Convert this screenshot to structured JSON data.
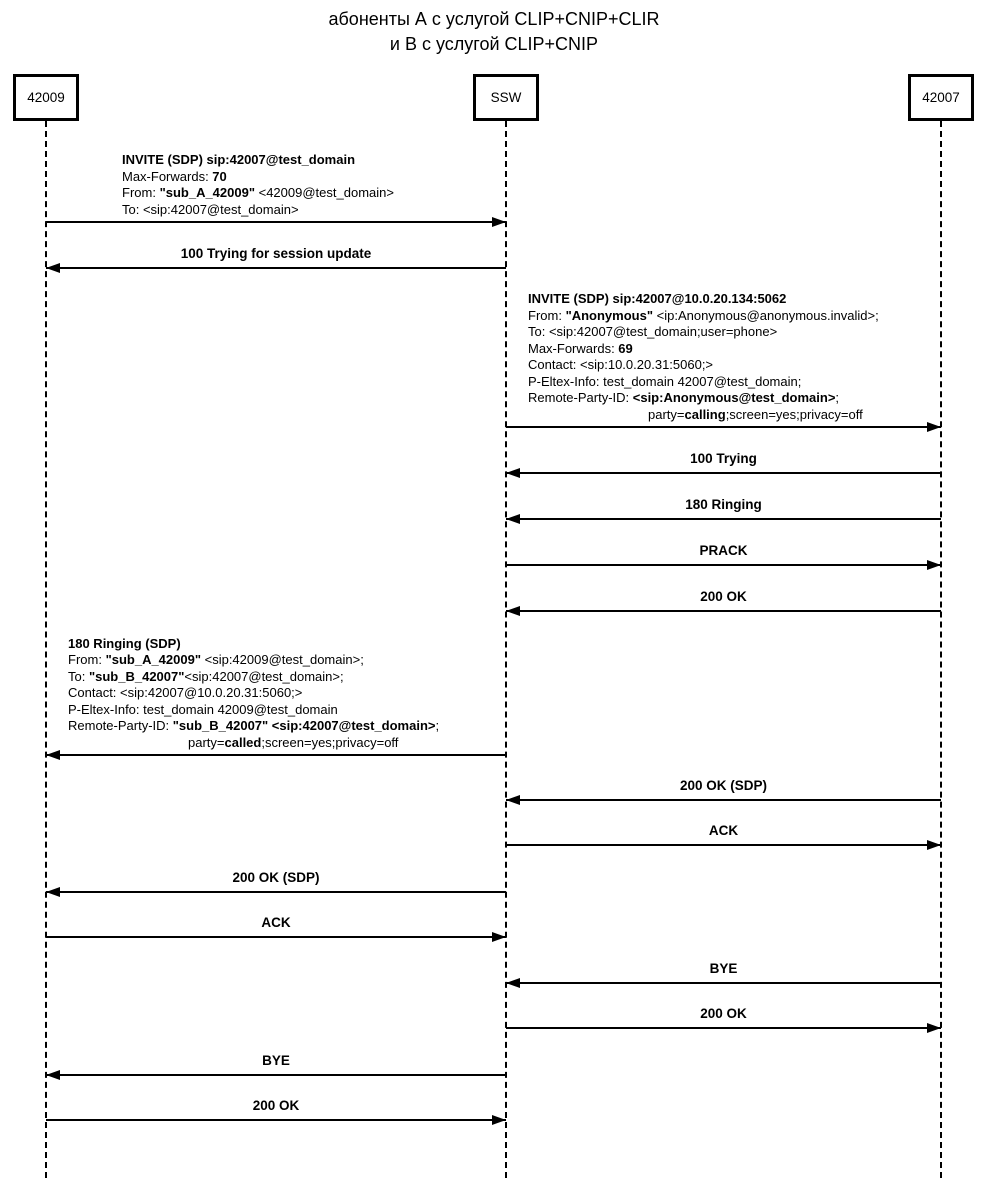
{
  "title": {
    "line1": "абоненты А с услугой CLIP+CNIP+CLIR",
    "line2": "и В с услугой CLIP+CNIP"
  },
  "accent_color": "#000000",
  "actors": [
    {
      "label": "42009",
      "x": 46
    },
    {
      "label": "SSW",
      "x": 506
    },
    {
      "label": "42007",
      "x": 941
    }
  ],
  "messages": [
    {
      "y": 222,
      "from": 46,
      "to": 506,
      "label_style": "block",
      "block_x": 122,
      "lines": [
        {
          "segs": [
            {
              "t": "INVITE (SDP) sip:42007@test_domain",
              "b": true
            }
          ]
        },
        {
          "segs": [
            {
              "t": "Max-Forwards: "
            },
            {
              "t": "70",
              "b": true
            }
          ]
        },
        {
          "segs": [
            {
              "t": "From: "
            },
            {
              "t": "\"sub_A_42009\"",
              "b": true
            },
            {
              "t": " <42009@test_domain>"
            }
          ]
        },
        {
          "segs": [
            {
              "t": "To: <sip:42007@test_domain>"
            }
          ]
        }
      ]
    },
    {
      "y": 268,
      "from": 506,
      "to": 46,
      "label_style": "center",
      "label": "100 Trying for session update"
    },
    {
      "y": 427,
      "from": 506,
      "to": 941,
      "label_style": "block",
      "block_x": 528,
      "lines": [
        {
          "segs": [
            {
              "t": "INVITE (SDP) sip:42007@10.0.20.134:5062",
              "b": true
            }
          ]
        },
        {
          "segs": [
            {
              "t": "From: "
            },
            {
              "t": "\"Anonymous\"",
              "b": true
            },
            {
              "t": " <ip:Anonymous@anonymous.invalid>;"
            }
          ]
        },
        {
          "segs": [
            {
              "t": "To: <sip:42007@test_domain;user=phone>"
            }
          ]
        },
        {
          "segs": [
            {
              "t": "Max-Forwards: "
            },
            {
              "t": "69",
              "b": true
            }
          ]
        },
        {
          "segs": [
            {
              "t": "Contact: <sip:10.0.20.31:5060;>"
            }
          ]
        },
        {
          "segs": [
            {
              "t": "P-Eltex-Info: test_domain 42007@test_domain;"
            }
          ]
        },
        {
          "segs": [
            {
              "t": "Remote-Party-ID: "
            },
            {
              "t": "<sip:Anonymous@test_domain>",
              "b": true
            },
            {
              "t": ";"
            }
          ]
        },
        {
          "indent": 120,
          "segs": [
            {
              "t": "party="
            },
            {
              "t": "calling",
              "b": true
            },
            {
              "t": ";screen=yes;privacy=off"
            }
          ]
        }
      ]
    },
    {
      "y": 473,
      "from": 941,
      "to": 506,
      "label_style": "center",
      "label": "100 Trying"
    },
    {
      "y": 519,
      "from": 941,
      "to": 506,
      "label_style": "center",
      "label": "180 Ringing"
    },
    {
      "y": 565,
      "from": 506,
      "to": 941,
      "label_style": "center",
      "label": "PRACK"
    },
    {
      "y": 611,
      "from": 941,
      "to": 506,
      "label_style": "center",
      "label": "200 OK"
    },
    {
      "y": 755,
      "from": 506,
      "to": 46,
      "label_style": "block",
      "block_x": 68,
      "lines": [
        {
          "segs": [
            {
              "t": "180 Ringing (SDP)",
              "b": true
            }
          ]
        },
        {
          "segs": [
            {
              "t": "From: "
            },
            {
              "t": "\"sub_A_42009\"",
              "b": true
            },
            {
              "t": " <sip:42009@test_domain>;"
            }
          ]
        },
        {
          "segs": [
            {
              "t": "To: "
            },
            {
              "t": "\"sub_B_42007\"",
              "b": true
            },
            {
              "t": "<sip:42007@test_domain>;"
            }
          ]
        },
        {
          "segs": [
            {
              "t": "Contact: <sip:42007@10.0.20.31:5060;>"
            }
          ]
        },
        {
          "segs": [
            {
              "t": "P-Eltex-Info: test_domain 42009@test_domain"
            }
          ]
        },
        {
          "segs": [
            {
              "t": "Remote-Party-ID: "
            },
            {
              "t": "\"sub_B_42007\" <sip:42007@test_domain>",
              "b": true
            },
            {
              "t": ";"
            }
          ]
        },
        {
          "indent": 120,
          "segs": [
            {
              "t": "party="
            },
            {
              "t": "called",
              "b": true
            },
            {
              "t": ";screen=yes;privacy=off"
            }
          ]
        }
      ]
    },
    {
      "y": 800,
      "from": 941,
      "to": 506,
      "label_style": "center",
      "label": "200 OK (SDP)"
    },
    {
      "y": 845,
      "from": 506,
      "to": 941,
      "label_style": "center",
      "label": "ACK"
    },
    {
      "y": 892,
      "from": 506,
      "to": 46,
      "label_style": "center",
      "label": "200 OK (SDP)"
    },
    {
      "y": 937,
      "from": 46,
      "to": 506,
      "label_style": "center",
      "label": "ACK"
    },
    {
      "y": 983,
      "from": 941,
      "to": 506,
      "label_style": "center",
      "label": "BYE"
    },
    {
      "y": 1028,
      "from": 506,
      "to": 941,
      "label_style": "center",
      "label": "200 OK"
    },
    {
      "y": 1075,
      "from": 506,
      "to": 46,
      "label_style": "center",
      "label": "BYE"
    },
    {
      "y": 1120,
      "from": 46,
      "to": 506,
      "label_style": "center",
      "label": "200 OK"
    }
  ]
}
